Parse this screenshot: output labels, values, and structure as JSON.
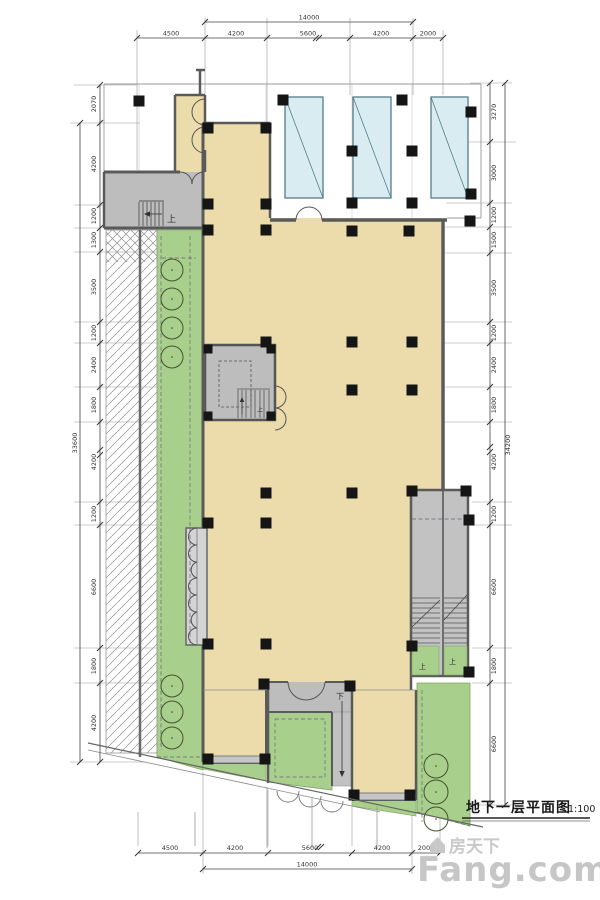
{
  "title": {
    "text": "地下一层平面图",
    "scale": "1:100"
  },
  "watermark": {
    "brand_cn": "房天下",
    "brand_en": "Fang.com"
  },
  "plan_labels": {
    "up": "上",
    "down": "下"
  },
  "dimensions": {
    "top": {
      "overall": "14000",
      "segments": [
        "4500",
        "4200",
        "5600",
        "4200",
        "2000"
      ]
    },
    "bottom": {
      "overall": "14000",
      "segments": [
        "4500",
        "4200",
        "5600",
        "4200",
        "2000"
      ]
    },
    "left": {
      "overall": "33600",
      "segments": [
        "2070",
        "4200",
        "1200",
        "1300",
        "3500",
        "1200",
        "2400",
        "1800",
        "4200",
        "1200",
        "6600",
        "1800",
        "4200"
      ]
    },
    "right": {
      "overall": "34200",
      "segments": [
        "3270",
        "3000",
        "1200",
        "1500",
        "3500",
        "1200",
        "2400",
        "1800",
        "4200",
        "1200",
        "6600",
        "1800",
        "6600"
      ]
    }
  },
  "colors": {
    "floor_beige": "#ecdcab",
    "circulation_gray": "#bdbdbd",
    "wall_gray": "#5a5a5a",
    "landscape_green": "#a9cf8d",
    "skylight_cyan": "#d8ecf1",
    "column_black": "#151515"
  }
}
